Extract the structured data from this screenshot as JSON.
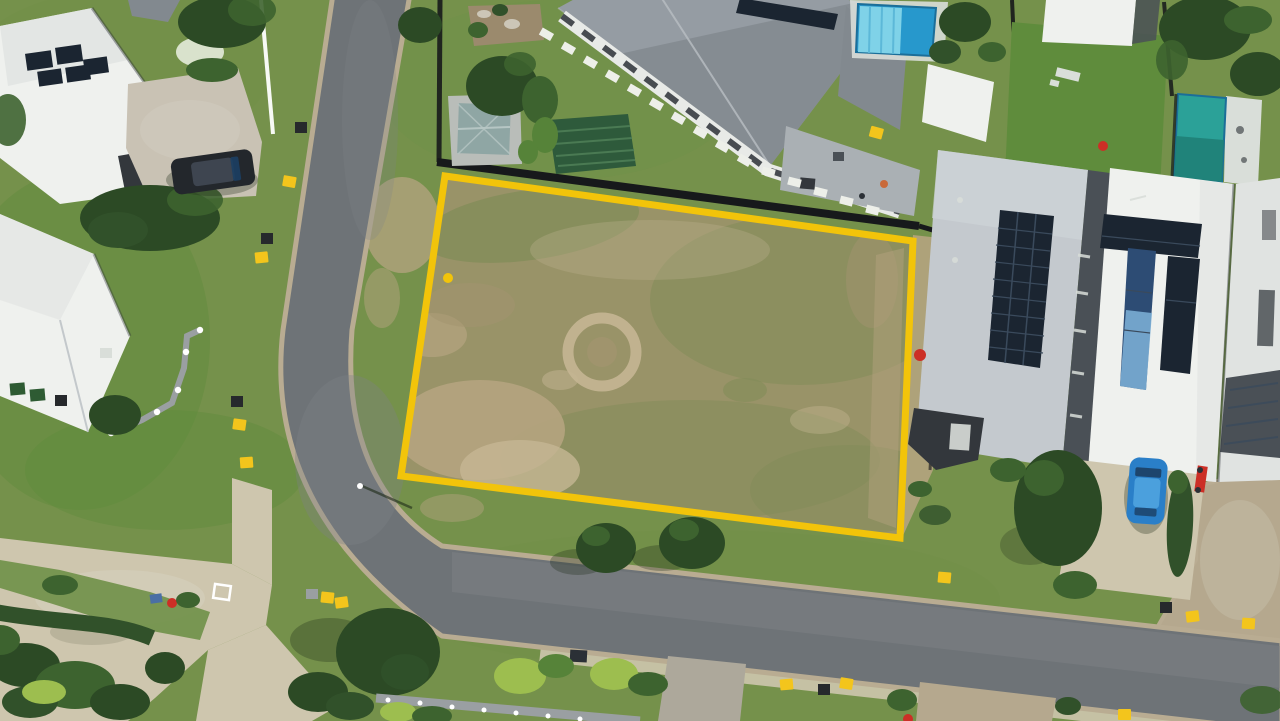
{
  "meta": {
    "description": "Aerial drone photograph of a vacant residential block of land outlined with a bright yellow boundary line, surrounded by modern suburban houses, curved asphalt streets, swimming pools, lawns, trees and kerbside bins",
    "type": "aerial-photograph",
    "width_px": 1280,
    "height_px": 721
  },
  "scene": {
    "vacant_lot": {
      "label": "vacant land parcel outlined in yellow",
      "boundary_color": "#F2C40A",
      "corners_px": [
        [
          445,
          176
        ],
        [
          913,
          241
        ],
        [
          900,
          538
        ],
        [
          401,
          476
        ]
      ],
      "surface": "patchy dry olive grass with brown dirt areas and a circular bare ring",
      "survey_dot_px": [
        448,
        278
      ],
      "fence": "dark timber fence along rear (top) boundary and part of right boundary"
    },
    "roads": [
      {
        "label": "street running from top edge, curving at bottom-left into the bottom street",
        "surface": "dark asphalt with concrete kerbs"
      },
      {
        "label": "exposed-aggregate side driveway joining from the right edge",
        "surface": "tan aggregate concrete"
      }
    ],
    "houses": [
      {
        "label": "top-left white house",
        "features": [
          "white hip roof",
          "rooftop solar panels",
          "dark SUV on driveway"
        ]
      },
      {
        "label": "left white house",
        "features": [
          "white hip roof",
          "green wheelie bins",
          "stepped grey retaining wall with white posts"
        ]
      },
      {
        "label": "top-centre grey-roof house",
        "features": [
          "large grey hip roof",
          "solar panels",
          "white stepping-stone path",
          "green shade canopy",
          "teal garden shed",
          "grey paver courtyard"
        ]
      },
      {
        "label": "top-right property",
        "features": [
          "blue swimming pool with light-blue cover",
          "bright lawn",
          "sun lounger",
          "white flat-roof cabana"
        ]
      },
      {
        "label": "right house with grey roof",
        "features": [
          "large dark solar array",
          "charcoal garage wing"
        ]
      },
      {
        "label": "right house with white roof",
        "features": [
          "T-shaped solar array with blue reflective panels",
          "blue hatchback on driveway",
          "red motorbike"
        ]
      },
      {
        "label": "far-right house",
        "features": [
          "teal lap pool",
          "dark hatched roof section"
        ]
      }
    ],
    "vehicles": [
      {
        "label": "dark SUV",
        "location": "top-left driveway"
      },
      {
        "label": "blue hatchback",
        "location": "right-side driveway"
      }
    ],
    "street_items": {
      "yellow_markers": 13,
      "dark_bins": 6,
      "green_bins": 2,
      "streetlight": 1
    },
    "vegetation": "street trees with cast shadows, lime-green shrubs, dense dark hedges bottom-left"
  },
  "colors": {
    "grass_verge": "#75914B",
    "lawn_bright": "#5F8C3C",
    "lawn_mid": "#6F9048",
    "lot_base": "#999368",
    "lot_green": "#828C58",
    "dirt": "#B5A480",
    "dirt_light": "#C5B694",
    "dirt_dark": "#A2946F",
    "boundary_yellow": "#F2C40A",
    "fence_black": "#17191B",
    "road_asphalt": "#6E7377",
    "road_light": "#7E8286",
    "curb": "#B9AC92",
    "concrete": "#CEC6AE",
    "aggregate": "#B5A88E",
    "aggregate_warm": "#C9C2B4",
    "path_gray": "#ADA89B",
    "pavers": "#AAB0B4",
    "roof_white": "#EFF1EE",
    "roof_white_shade": "#E0E3E1",
    "roof_lightgray": "#C4C9CE",
    "roof_lighter": "#CFD4D8",
    "roof_midgray": "#959CA3",
    "roof_midgray_dark": "#82898F",
    "roof_darkgray": "#4A5056",
    "roof_charcoal": "#33373C",
    "roof_ridge": "#B9BEC3",
    "wall_white": "#E8EAE7",
    "wall_gray": "#9A9FA2",
    "window_dark": "#2B3036",
    "solar_dark": "#1B2531",
    "solar_grid": "#3A4A5C",
    "solar_navy": "#2D4C74",
    "solar_blue": "#7FB3D9",
    "pool_blue": "#2798CC",
    "pool_cover": "#7FD2E8",
    "pool_edge": "#1B6E99",
    "cover_stripe": "#5CB8D8",
    "pool_teal": "#2BA198",
    "pool_teal_dark": "#1F8077",
    "deck_white": "#D9DED9",
    "tree_dark": "#2C4A25",
    "tree_mid": "#3D632F",
    "tree_light": "#568339",
    "lime": "#9DBE4F",
    "hedge_dark": "#31512A",
    "shadow": "#1E2A18",
    "flower_white": "#D9E2CC",
    "car_black": "#23272C",
    "suv_roof": "#3E4550",
    "car_blue": "#2A7FC8",
    "car_blue_light": "#4BA0DD",
    "glass_dark": "#1C3F63",
    "marker_yellow": "#F3C51C",
    "bin_dark": "#26292C",
    "bin_green": "#2E5B33",
    "shed_teal": "#8FA6A4",
    "shed_pad": "#B9BDB9",
    "shed_ridge": "#B6C6C4",
    "canopy_green": "#2E5A3B",
    "canopy_rib": "#4A7A53",
    "stone_white": "#EDEFE9",
    "garden_soil": "#9B8A6D",
    "red_accent": "#CC2F26",
    "orange_accent": "#C96A3A",
    "post_white": "#FFFFFF",
    "play_blue": "#4A6FA5"
  }
}
